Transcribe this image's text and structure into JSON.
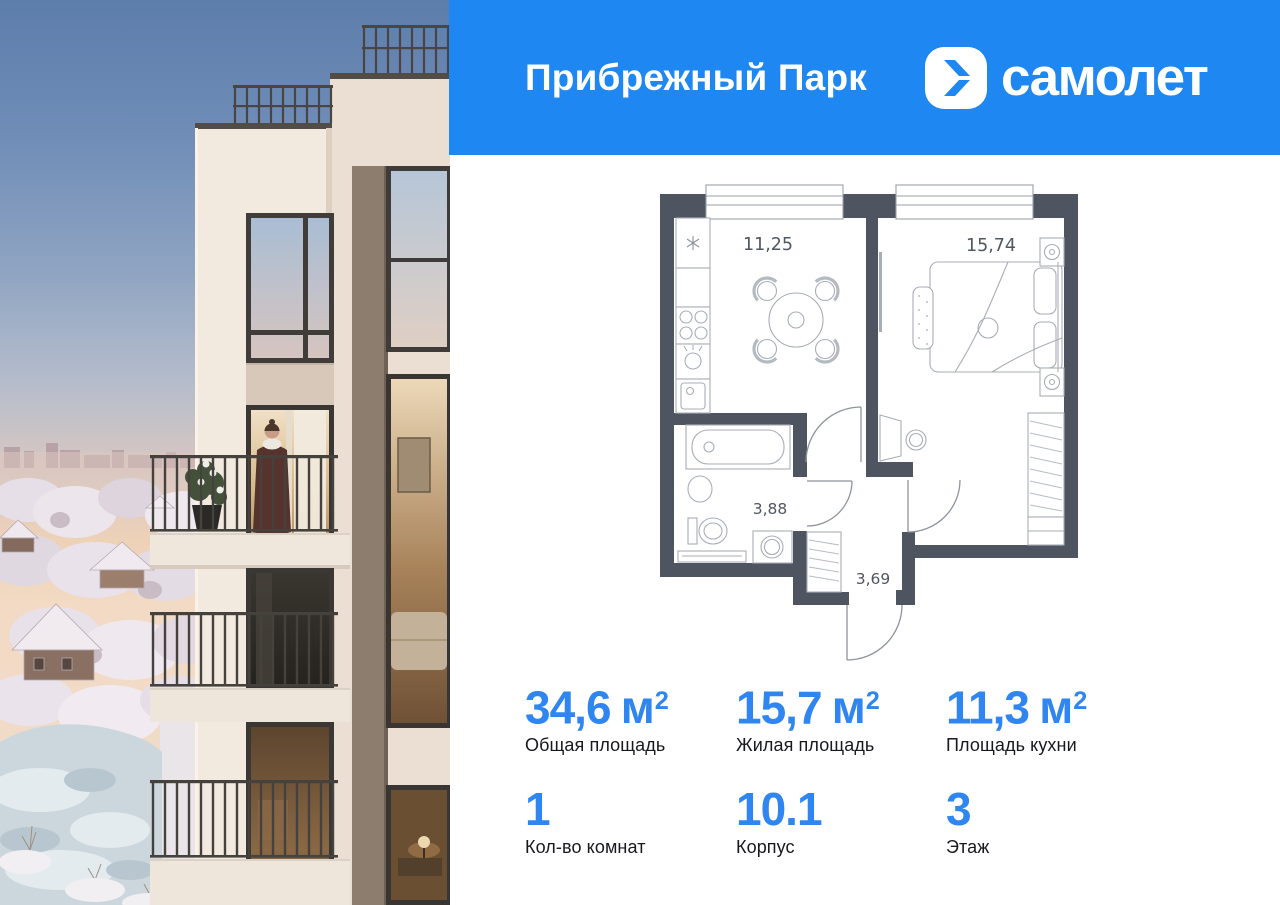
{
  "header": {
    "title": "Прибрежный Парк",
    "brand": "самолет"
  },
  "floor_plan": {
    "rooms": {
      "kitchen": {
        "name": "кухня",
        "area": "11,25"
      },
      "living": {
        "name": "комната",
        "area": "15,74"
      },
      "bathroom": {
        "name": "санузел",
        "area": "3,88"
      },
      "hallway": {
        "name": "прихожая",
        "area": "3,69"
      }
    }
  },
  "stats": {
    "total_area": {
      "value": "34,6",
      "unit": "м",
      "sup": "2",
      "label": "Общая площадь"
    },
    "living_area": {
      "value": "15,7",
      "unit": "м",
      "sup": "2",
      "label": "Жилая площадь"
    },
    "kitchen_area": {
      "value": "11,3",
      "unit": "м",
      "sup": "2",
      "label": "Площадь кухни"
    },
    "rooms_count": {
      "value": "1",
      "label": "Кол-во комнат"
    },
    "building": {
      "value": "10.1",
      "label": "Корпус"
    },
    "floor": {
      "value": "3",
      "label": "Этаж"
    }
  },
  "colors": {
    "header_bg": "#1e87f2",
    "number_accent": "#2f86f1",
    "plan_wall": "#4e5460"
  }
}
